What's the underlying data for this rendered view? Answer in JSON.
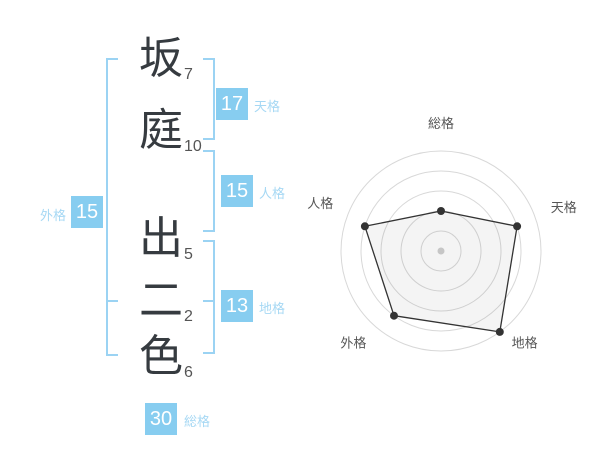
{
  "name_panel": {
    "characters": [
      {
        "char": "坂",
        "strokes": "7"
      },
      {
        "char": "庭",
        "strokes": "10"
      },
      {
        "char": "出",
        "strokes": "5"
      },
      {
        "char": "二",
        "strokes": "2"
      },
      {
        "char": "色",
        "strokes": "6"
      }
    ],
    "scores": {
      "tenkaku": {
        "value": "17",
        "label": "天格"
      },
      "jinkaku": {
        "value": "15",
        "label": "人格"
      },
      "chikaku": {
        "value": "13",
        "label": "地格"
      },
      "gaikaku": {
        "value": "15",
        "label": "外格"
      },
      "soukaku": {
        "value": "30",
        "label": "総格"
      }
    }
  },
  "colors": {
    "badge_blue": "#87cdf0",
    "label_blue": "#a6d8f4",
    "bracket_blue": "#9bd3f3",
    "name_text": "#363b40",
    "stroke_number": "#555555",
    "radar_ring": "#d8d8d8",
    "radar_line": "#333333",
    "radar_label": "#565656",
    "radar_center_dot": "#c6c6c6"
  },
  "chart_data": {
    "type": "radar",
    "axes": [
      {
        "key": "soukaku",
        "label": "総格",
        "value": 40
      },
      {
        "key": "tenkaku",
        "label": "天格",
        "value": 80
      },
      {
        "key": "chikaku",
        "label": "地格",
        "value": 100
      },
      {
        "key": "gaikaku",
        "label": "外格",
        "value": 80
      },
      {
        "key": "jinkaku",
        "label": "人格",
        "value": 80
      }
    ],
    "max": 100,
    "rings": [
      20,
      40,
      60,
      80,
      100
    ],
    "grid": "circular",
    "legend": "none",
    "title": ""
  }
}
